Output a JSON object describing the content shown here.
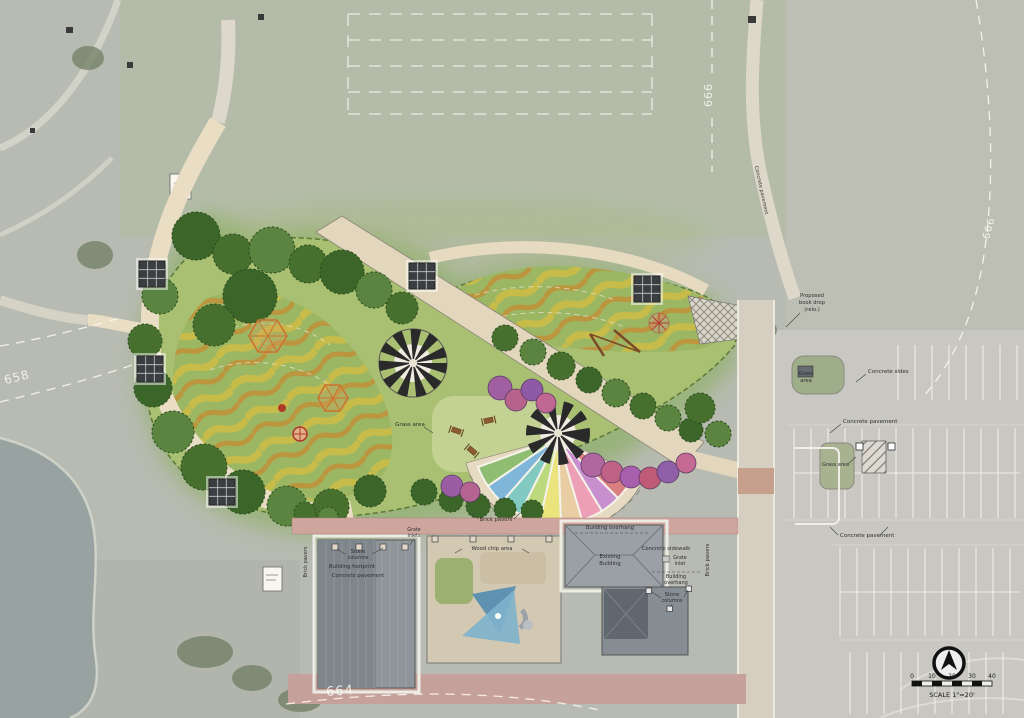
{
  "contours": {
    "top": "666",
    "right": "666",
    "left": "658",
    "bottom": "664"
  },
  "north_scale": {
    "tick_0": "0",
    "tick_10": "10",
    "tick_20": "20",
    "tick_30": "30",
    "tick_40": "40",
    "scale_text": "SCALE 1\"=20'"
  },
  "labels": {
    "concrete_pavement_path": "Concrete pavement",
    "book_drop_l1": "Proposed",
    "book_drop_l2": "book drop",
    "book_drop_l3": "(relo.)",
    "grass_area_island_l1": "Grass",
    "grass_area_island_l2": "area",
    "concrete_sides": "Concrete sides",
    "concrete_pavement_lot": "Concrete pavement",
    "grass_area_lot": "Grass area",
    "concrete_pavement_south": "Concrete pavement",
    "grass_area_center": "Grass area",
    "brick_pavers_plaza": "Brick pavers",
    "building_overhang_west": "Building overhang",
    "stone_columns_west_l1": "Stone",
    "stone_columns_west_l2": "columns",
    "building_footprint": "Building footprint",
    "concrete_pavement_building": "Concrete pavement",
    "grate_inlets_l1": "Grate",
    "grate_inlets_l2": "inlets",
    "wood_chip_area": "Wood chip area",
    "existing_building_l1": "Existing",
    "existing_building_l2": "Building",
    "concrete_sidewalk": "Concrete sidewalk",
    "grate_inlet_l1": "Grate",
    "grate_inlet_l2": "inlet",
    "building_overhang_east_l1": "Building",
    "building_overhang_east_l2": "overhang",
    "stone_columns_east_l1": "Stone",
    "stone_columns_east_l2": "columns",
    "brick_pavers_east_vertical": "Brick pavers",
    "brick_pavers_west_vertical": "Brick pavers"
  },
  "colors": {
    "aerial_base": "#b8bbb1",
    "field": "#b4bca9",
    "pond": "#98a2a1",
    "lawn": "#a9bf72",
    "stripe_yellow": "#d2bc44",
    "stripe_orange": "#c9862e",
    "tree_green": "#47702f",
    "path_beige": "#e9ddc4",
    "promenade": "#e2d6bd",
    "roof_gray": "#8e959b",
    "brick_plaza": "#c6a19b",
    "play_orange": "#c8742e",
    "rainbow": [
      "#8fbd72",
      "#7fb6d9",
      "#82cac1",
      "#bcd97e",
      "#ebe37c",
      "#e9cda3",
      "#ec9fb7",
      "#c78fcd",
      "#d97f7f"
    ]
  }
}
